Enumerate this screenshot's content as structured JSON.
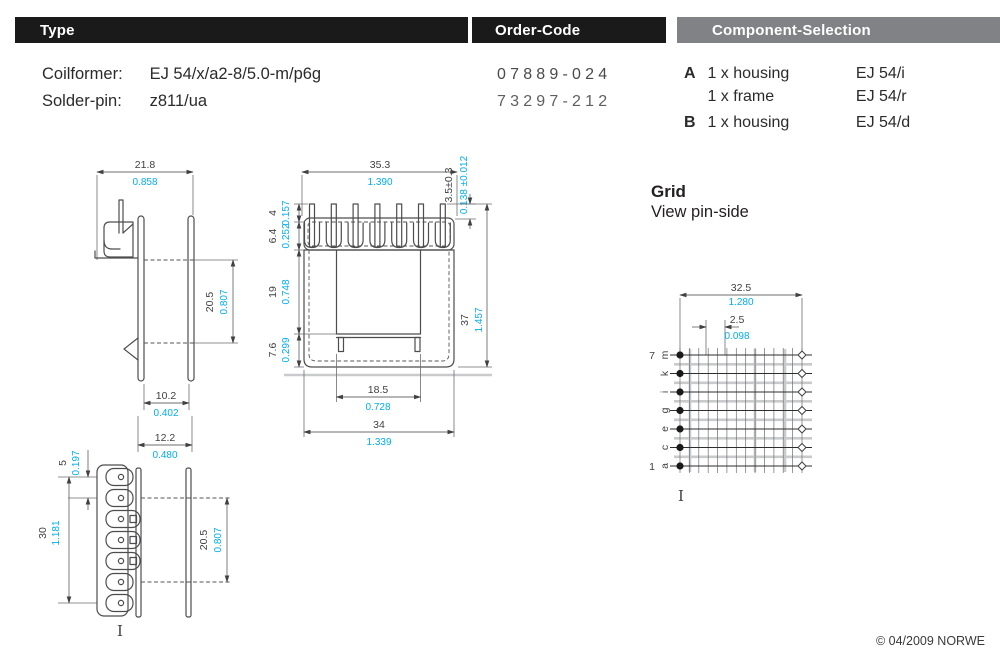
{
  "header_bars": {
    "type": "Type",
    "order_code": "Order-Code",
    "component_selection": "Component-Selection"
  },
  "type_section": {
    "rows": [
      {
        "label": "Coilformer:",
        "value": "EJ 54/x/a2-8/5.0-m/p6g"
      },
      {
        "label": "Solder-pin:",
        "value": "z811/ua"
      }
    ]
  },
  "order_code_section": {
    "codes": [
      "07889-024",
      "73297-212"
    ]
  },
  "component_selection_section": {
    "rows": [
      {
        "key": "A",
        "item": "1 x housing",
        "part": "EJ 54/i"
      },
      {
        "key": "",
        "item": "1 x frame",
        "part": "EJ 54/r"
      },
      {
        "key": "B",
        "item": "1 x housing",
        "part": "EJ 54/d"
      }
    ]
  },
  "grid_section": {
    "title": "Grid",
    "subtitle": "View pin-side",
    "row_num_top": "7",
    "row_num_bottom": "1",
    "row_letters": [
      "m",
      "k",
      "i",
      "g",
      "e",
      "c",
      "a"
    ]
  },
  "dims": {
    "side": {
      "w_top": {
        "mm": "21.8",
        "in": "0.858"
      },
      "h_win": {
        "mm": "20.5",
        "in": "0.807"
      },
      "w_in": {
        "mm": "10.2",
        "in": "0.402"
      },
      "w_fl": {
        "mm": "12.2",
        "in": "0.480"
      }
    },
    "front": {
      "w_top": {
        "mm": "35.3",
        "in": "1.390"
      },
      "pin_len": {
        "mm": "3.5±0.3",
        "in": "0.138 ±0.012"
      },
      "pin_top": {
        "mm": "4",
        "in": "0.157"
      },
      "flange": {
        "mm": "6.4",
        "in": "0.252"
      },
      "window": {
        "mm": "19",
        "in": "0.748"
      },
      "base": {
        "mm": "7.6",
        "in": "0.299"
      },
      "h_total": {
        "mm": "37",
        "in": "1.457"
      },
      "w_win": {
        "mm": "18.5",
        "in": "0.728"
      },
      "w_body": {
        "mm": "34",
        "in": "1.339"
      }
    },
    "top": {
      "pitch": {
        "mm": "5",
        "in": "0.197"
      },
      "len": {
        "mm": "30",
        "in": "1.181"
      },
      "width": {
        "mm": "20.5",
        "in": "0.807"
      }
    },
    "grid": {
      "span": {
        "mm": "32.5",
        "in": "1.280"
      },
      "pitch": {
        "mm": "2.5",
        "in": "0.098"
      }
    }
  },
  "misc": {
    "pin1_marker": "I"
  },
  "footer": {
    "copyright": "© 04/2009 NORWE"
  },
  "colors": {
    "accent_cyan": "#00AEEF",
    "bar_black": "#1A1A1A",
    "bar_gray": "#808285",
    "line_gray": "#C9CACC"
  }
}
